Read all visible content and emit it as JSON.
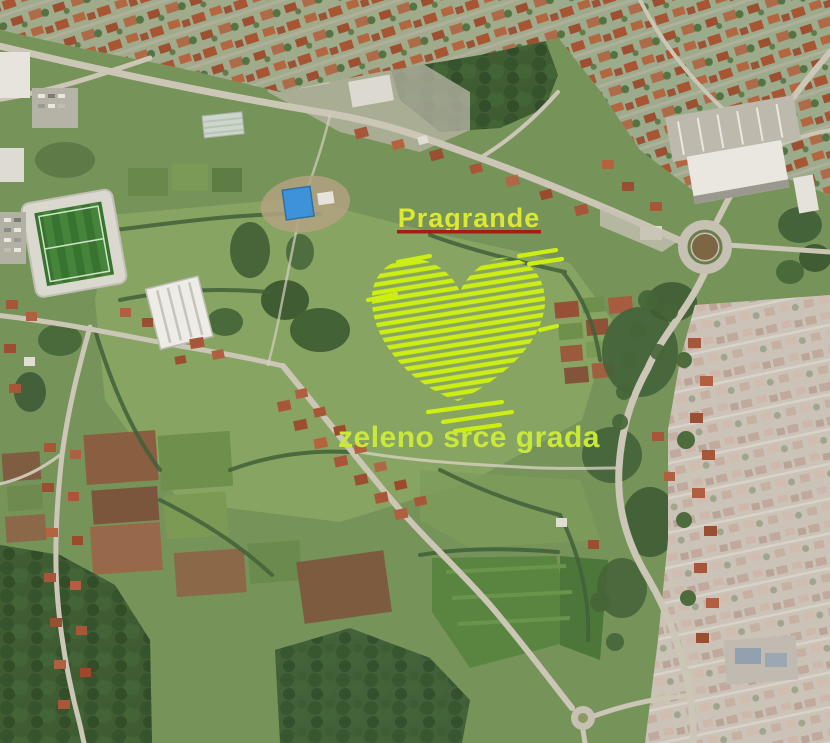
{
  "annotations": {
    "place_label": "Pragrande",
    "caption": "zeleno srce grada",
    "colors": {
      "place_label": "#dde833",
      "caption": "#c9e83a",
      "underline": "#9e2012",
      "heart": "#cdee15"
    }
  }
}
